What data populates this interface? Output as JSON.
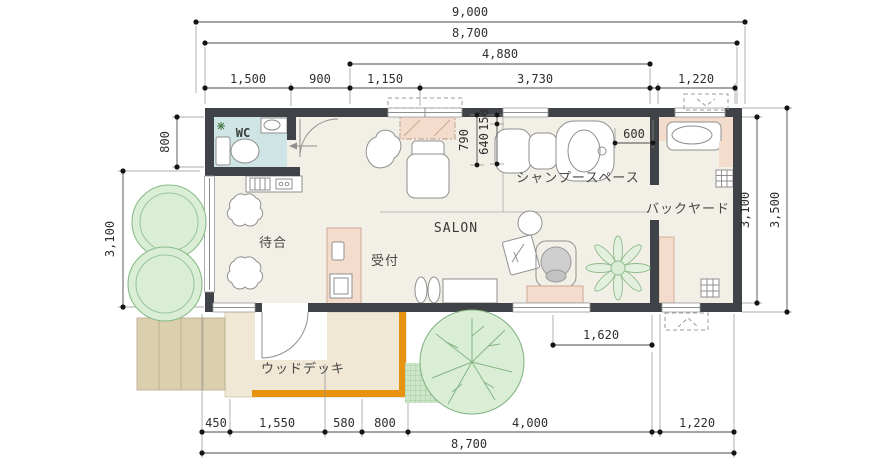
{
  "rooms": {
    "wc": "WC",
    "waiting": "待合",
    "reception": "受付",
    "salon": "SALON",
    "shampoo": "シャンプースペース",
    "backyard": "バックヤード",
    "deck": "ウッドデッキ"
  },
  "dims": {
    "top": {
      "total": "9,000",
      "building": "8,700",
      "inner": "4,880",
      "segments": [
        "1,500",
        "900",
        "1,150",
        "3,730",
        "1,220"
      ]
    },
    "left": {
      "wc_depth": "800",
      "side": "3,100"
    },
    "right": {
      "inner": "3,100",
      "overall": "3,500"
    },
    "detail": {
      "d790": "790",
      "d150": "150",
      "d640": "640",
      "d600": "600",
      "d1620": "1,620"
    },
    "bottom": {
      "segments": [
        "450",
        "1,550",
        "580",
        "800",
        "4,000",
        "1,220"
      ],
      "total": "8,700"
    }
  },
  "colors": {
    "wall": "#3f4347",
    "floor": "#f2efe6",
    "wc_floor": "#cfe4e4",
    "pink": "#f3dccc",
    "deck": "#f0e7d4",
    "deck_edge": "#e8930f",
    "steps": "#dccfae",
    "plant_fill": "#daeed5",
    "plant_stroke": "#8aba8a",
    "garden_bed": "#cde5c8"
  }
}
